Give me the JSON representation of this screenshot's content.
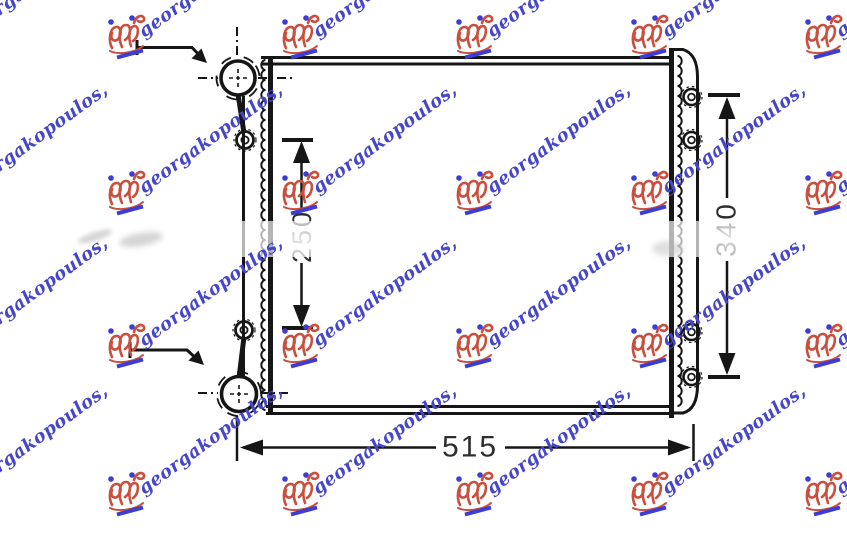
{
  "page": {
    "background": "#ffffff"
  },
  "watermark": {
    "text": "georgakopoulos,",
    "text_color": "#4646c8",
    "emblem_color": "#c94f3e",
    "underline_color": "#3d3dd2",
    "dot_color": "#3d3dd2"
  },
  "diagram": {
    "ink_color": "#161616",
    "dim_text_color": "#2e2e2e",
    "dimensions": {
      "width": "515",
      "height": "340",
      "core_height": "250"
    }
  }
}
